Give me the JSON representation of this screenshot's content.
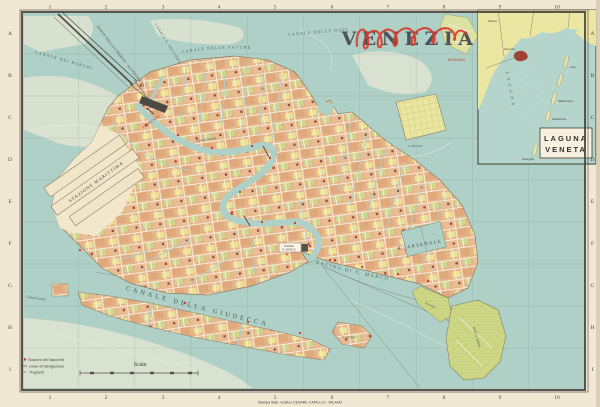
{
  "title": {
    "text": "VENEZIA"
  },
  "grid": {
    "cols": [
      "1",
      "2",
      "3",
      "4",
      "5",
      "6",
      "7",
      "8",
      "9",
      "10"
    ],
    "rows": [
      "A",
      "B",
      "C",
      "D",
      "E",
      "F",
      "G",
      "H",
      "I"
    ]
  },
  "water_labels": {
    "borghi": "CANALE DEI BORGHI",
    "secondo": "CANALE S. SECONDO",
    "sacche": "CANALE DELLE SACCHE",
    "navi": "CANALE DELLE NAVI",
    "giudecca": "CANALE DELLA GIUDECCA",
    "bacino": "BACINO DI S. MARCO",
    "canal_grande": "Canal Grande",
    "fusina": "Canal Fusina"
  },
  "place_labels": {
    "ponte_liberta": "PONTE DELLA LIBERTÀ - AUTOSTRADA",
    "marittima": "STAZIONE MARITTIMA",
    "arsenale": "R. ARSENALE",
    "piazza_line1": "PIAZZA",
    "piazza_line2": "S. MARCO",
    "ferrovia": "FERROVIA",
    "murano": "MURANO",
    "michele": "S. Michele",
    "giorgio": "S. Giorgio",
    "giardini": "Giardini",
    "elena": "Isola S. Elena"
  },
  "inset": {
    "box_line1": "LAGUNA",
    "box_line2": "VENETA",
    "lagoon_vertical": "LAGUNA",
    "labels": {
      "mestre": "Mestre",
      "venezia": "Venezia",
      "lido": "Lido",
      "malamocco": "Malamocco",
      "pellestrina": "Pellestrina",
      "chioggia": "Chioggia"
    }
  },
  "legend": {
    "vaporetti": "Stazioni dei Vaporetti",
    "navigazione": "Linee di Navigazione",
    "traghetti": "Traghetti"
  },
  "scale": {
    "label": "Scala"
  },
  "imprint": "Stampa Stab. Grafico CESARE CAPELLO - MILANO",
  "colors": {
    "paper": "#f1e8d4",
    "water": "#aed0c6",
    "shoal": "#e3e6d2",
    "block_salmon": "#e6b48a",
    "block_yellow": "#ece293",
    "block_green": "#cfd68b",
    "title_ink": "#4d525b",
    "accent_red": "#c23a28",
    "frame_ink": "#4a4540"
  }
}
